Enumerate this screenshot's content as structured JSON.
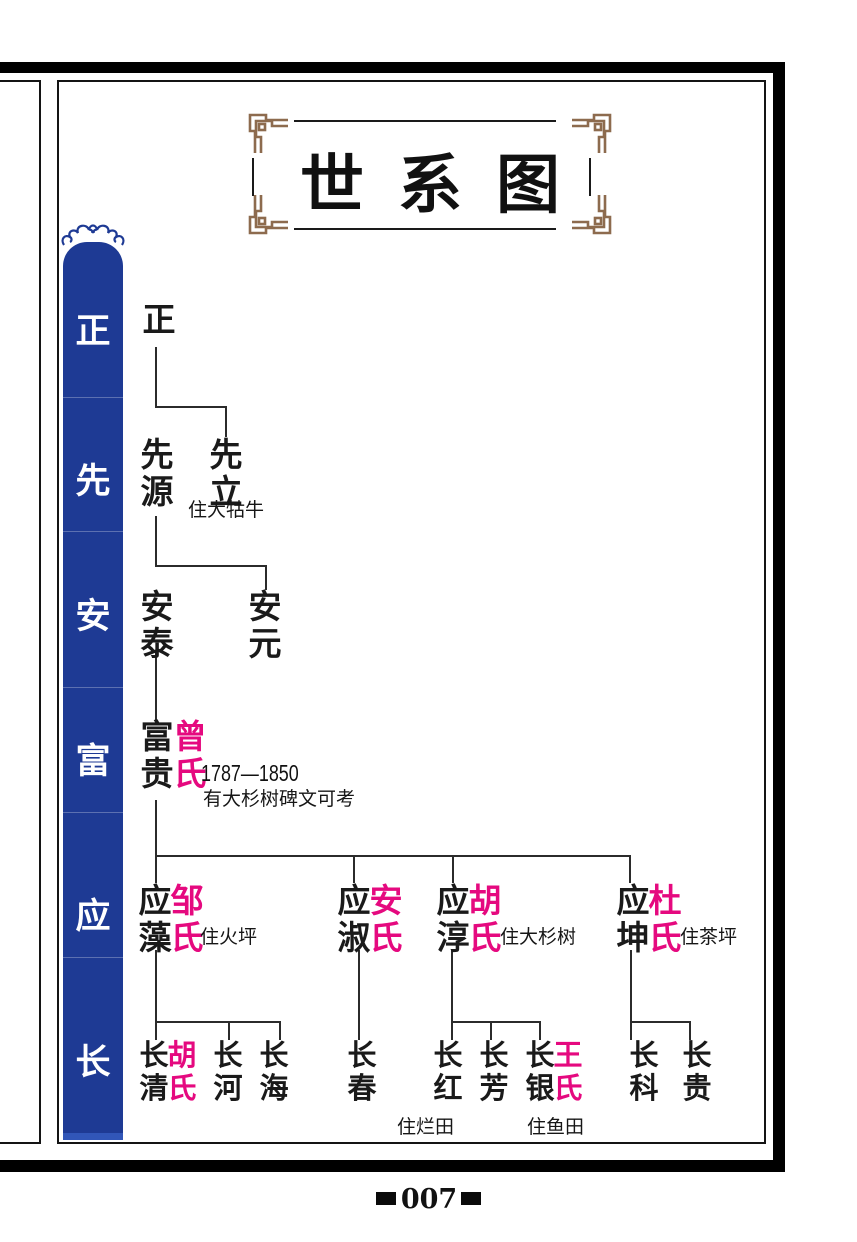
{
  "page": {
    "title": "世系图",
    "page_number": "007"
  },
  "sidebar": {
    "generation_labels": [
      "正",
      "先",
      "安",
      "富",
      "应",
      "长"
    ]
  },
  "tree": {
    "persons": [
      {
        "name": "正"
      },
      {
        "name": "先源"
      },
      {
        "name": "先立",
        "note": "住大牯牛"
      },
      {
        "name": "安泰"
      },
      {
        "name": "安元"
      },
      {
        "name": "富贵",
        "spouse": "曾氏",
        "dates": "1787—1850",
        "note": "有大杉树碑文可考"
      },
      {
        "name": "应藻",
        "spouse": "邹氏",
        "note": "住火坪"
      },
      {
        "name": "应淑",
        "spouse": "安氏"
      },
      {
        "name": "应淳",
        "spouse": "胡氏",
        "note": "住大杉树"
      },
      {
        "name": "应坤",
        "spouse": "杜氏",
        "note": "住茶坪"
      },
      {
        "name": "长清",
        "spouse": "胡氏"
      },
      {
        "name": "长河"
      },
      {
        "name": "长海"
      },
      {
        "name": "长春"
      },
      {
        "name": "长红",
        "note": "住烂田"
      },
      {
        "name": "长芳"
      },
      {
        "name": "长银",
        "spouse": "王氏",
        "note": "住鱼田"
      },
      {
        "name": "长科"
      },
      {
        "name": "长贵"
      }
    ]
  },
  "colors": {
    "sidebar_blue": "#1e3a94",
    "spouse_magenta": "#e5097f",
    "frame_brown": "#8d6b4e"
  }
}
